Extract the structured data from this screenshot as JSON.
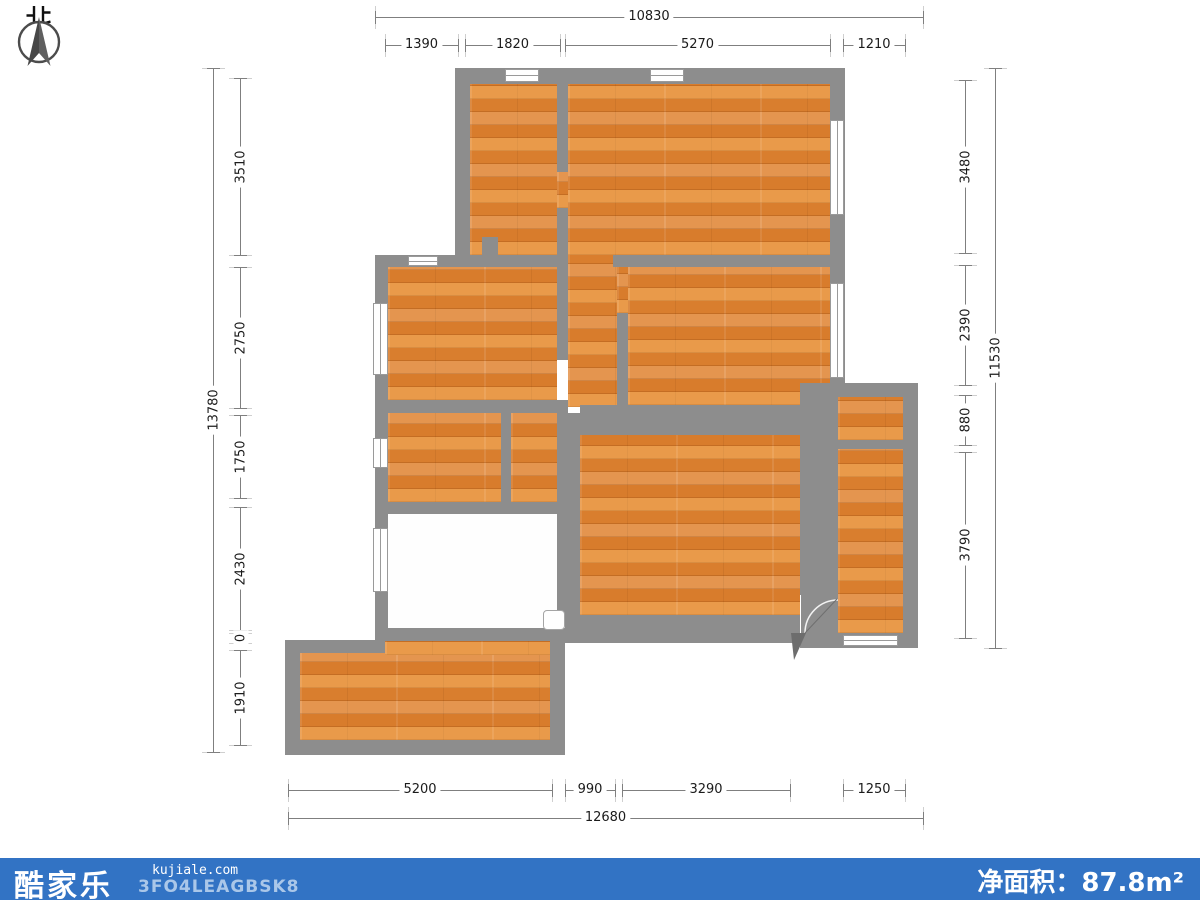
{
  "compass": {
    "north_label": "北"
  },
  "dimensions": {
    "top": {
      "total": "10830",
      "segments": [
        "1390",
        "1820",
        "5270",
        "1210"
      ]
    },
    "left": {
      "total": "13780",
      "segments": [
        "3510",
        "2750",
        "1750",
        "2430",
        "0",
        "1910"
      ]
    },
    "right": {
      "total": "11530",
      "segments": [
        "3480",
        "2390",
        "880",
        "3790"
      ]
    },
    "bottom": {
      "total": "12680",
      "segments": [
        "5200",
        "990",
        "3290",
        "1250"
      ]
    }
  },
  "footer": {
    "logo_text": "酷家乐",
    "website": "kujiale.com",
    "code": "3FO4LEAGBSK8",
    "area_label": "净面积：",
    "area_value": "87.8",
    "area_unit": "m²"
  },
  "colors": {
    "footer_bar": "#3273c4",
    "footer_code_text": "#aac7e9",
    "wall": "#8d8d8d",
    "floor_wood": "#e08432",
    "window": "#ffffff",
    "dim_line": "#7f7f7f",
    "dim_text": "#1b1b1b"
  }
}
